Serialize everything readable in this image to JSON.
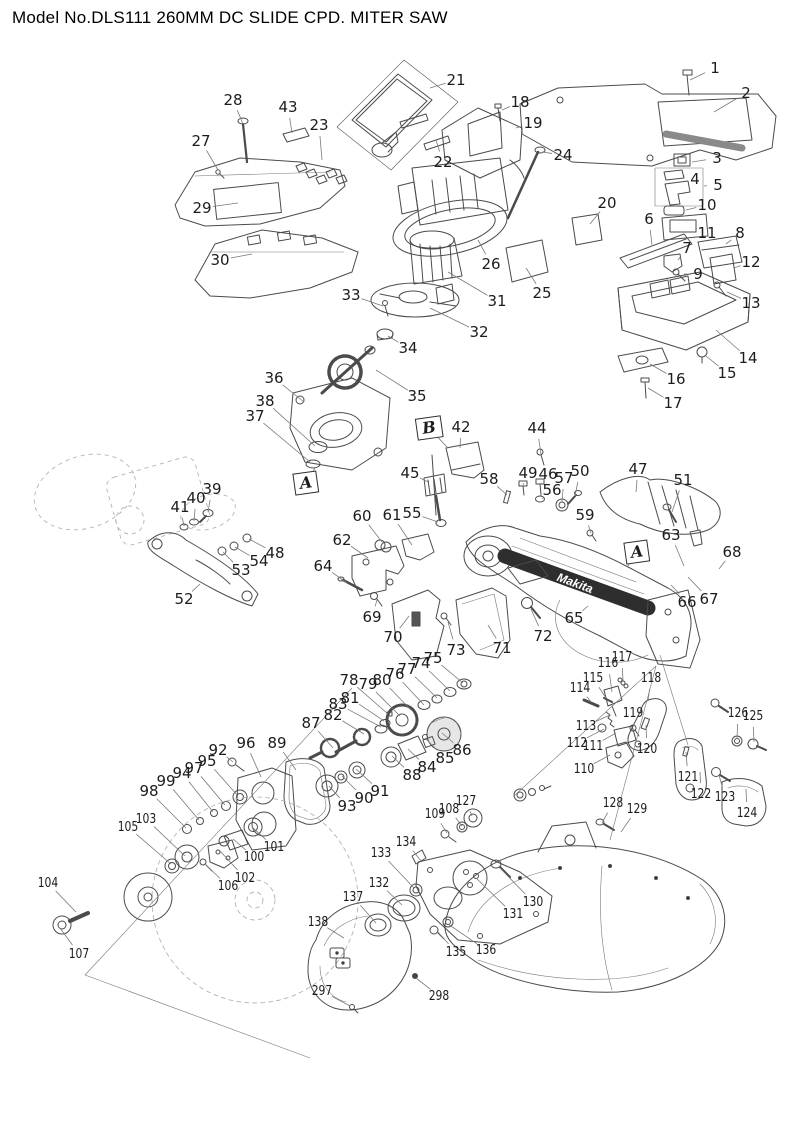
{
  "title": "Model No.DLS111 260MM DC SLIDE CPD. MITER SAW",
  "diagram": {
    "type": "exploded-parts-diagram",
    "brand_marking": "Makita",
    "view_refs": [
      {
        "label": "A",
        "x": 306,
        "y": 483,
        "tx": 315,
        "ty": 468
      },
      {
        "label": "B",
        "x": 429,
        "y": 428,
        "tx": 448,
        "ty": 448
      },
      {
        "label": "A",
        "x": 637,
        "y": 552,
        "tx": 628,
        "ty": 566
      }
    ],
    "callouts": [
      {
        "n": "1",
        "x": 715,
        "y": 68,
        "tx": 690,
        "ty": 80
      },
      {
        "n": "2",
        "x": 746,
        "y": 93,
        "tx": 714,
        "ty": 112
      },
      {
        "n": "3",
        "x": 717,
        "y": 158,
        "tx": 692,
        "ty": 162
      },
      {
        "n": "4",
        "x": 695,
        "y": 179,
        "tx": 684,
        "ty": 176
      },
      {
        "n": "5",
        "x": 718,
        "y": 185,
        "tx": 704,
        "ty": 186
      },
      {
        "n": "6",
        "x": 649,
        "y": 219,
        "tx": 652,
        "ty": 245
      },
      {
        "n": "7",
        "x": 687,
        "y": 248,
        "tx": 678,
        "ty": 260
      },
      {
        "n": "8",
        "x": 740,
        "y": 233,
        "tx": 726,
        "ty": 244
      },
      {
        "n": "9",
        "x": 698,
        "y": 274,
        "tx": 684,
        "ty": 274
      },
      {
        "n": "10",
        "x": 707,
        "y": 205,
        "tx": 686,
        "ty": 210
      },
      {
        "n": "11",
        "x": 707,
        "y": 233,
        "tx": 696,
        "ty": 228
      },
      {
        "n": "12",
        "x": 751,
        "y": 262,
        "tx": 734,
        "ty": 268
      },
      {
        "n": "13",
        "x": 751,
        "y": 303,
        "tx": 727,
        "ty": 292
      },
      {
        "n": "14",
        "x": 748,
        "y": 358,
        "tx": 716,
        "ty": 330
      },
      {
        "n": "15",
        "x": 727,
        "y": 373,
        "tx": 706,
        "ty": 356
      },
      {
        "n": "16",
        "x": 676,
        "y": 379,
        "tx": 650,
        "ty": 364
      },
      {
        "n": "17",
        "x": 673,
        "y": 403,
        "tx": 648,
        "ty": 388
      },
      {
        "n": "18",
        "x": 520,
        "y": 102,
        "tx": 502,
        "ty": 110
      },
      {
        "n": "19",
        "x": 533,
        "y": 123,
        "tx": 516,
        "ty": 128
      },
      {
        "n": "20",
        "x": 607,
        "y": 203,
        "tx": 590,
        "ty": 224
      },
      {
        "n": "21",
        "x": 456,
        "y": 80,
        "tx": 430,
        "ty": 88
      },
      {
        "n": "22",
        "x": 443,
        "y": 162,
        "tx": 436,
        "ty": 140
      },
      {
        "n": "23",
        "x": 319,
        "y": 125,
        "tx": 322,
        "ty": 160
      },
      {
        "n": "24",
        "x": 563,
        "y": 155,
        "tx": 542,
        "ty": 152
      },
      {
        "n": "25",
        "x": 542,
        "y": 293,
        "tx": 526,
        "ty": 268
      },
      {
        "n": "26",
        "x": 491,
        "y": 264,
        "tx": 478,
        "ty": 240
      },
      {
        "n": "27",
        "x": 201,
        "y": 141,
        "tx": 218,
        "ty": 170
      },
      {
        "n": "28",
        "x": 233,
        "y": 100,
        "tx": 243,
        "ty": 124
      },
      {
        "n": "29",
        "x": 202,
        "y": 208,
        "tx": 238,
        "ty": 203
      },
      {
        "n": "30",
        "x": 220,
        "y": 260,
        "tx": 252,
        "ty": 254
      },
      {
        "n": "31",
        "x": 497,
        "y": 301,
        "tx": 448,
        "ty": 272
      },
      {
        "n": "32",
        "x": 479,
        "y": 332,
        "tx": 430,
        "ty": 308
      },
      {
        "n": "33",
        "x": 351,
        "y": 295,
        "tx": 383,
        "ty": 306
      },
      {
        "n": "34",
        "x": 408,
        "y": 348,
        "tx": 388,
        "ty": 336
      },
      {
        "n": "35",
        "x": 417,
        "y": 396,
        "tx": 376,
        "ty": 370
      },
      {
        "n": "36",
        "x": 274,
        "y": 378,
        "tx": 304,
        "ty": 402
      },
      {
        "n": "37",
        "x": 255,
        "y": 416,
        "tx": 310,
        "ty": 462
      },
      {
        "n": "38",
        "x": 265,
        "y": 401,
        "tx": 315,
        "ty": 446
      },
      {
        "n": "39",
        "x": 212,
        "y": 489,
        "tx": 208,
        "ty": 512
      },
      {
        "n": "40",
        "x": 196,
        "y": 498,
        "tx": 194,
        "ty": 521
      },
      {
        "n": "41",
        "x": 180,
        "y": 507,
        "tx": 184,
        "ty": 526
      },
      {
        "n": "42",
        "x": 461,
        "y": 427,
        "tx": 460,
        "ty": 448
      },
      {
        "n": "43",
        "x": 288,
        "y": 107,
        "tx": 292,
        "ty": 133
      },
      {
        "n": "44",
        "x": 537,
        "y": 428,
        "tx": 541,
        "ty": 454
      },
      {
        "n": "45",
        "x": 410,
        "y": 473,
        "tx": 428,
        "ty": 482
      },
      {
        "n": "46",
        "x": 548,
        "y": 474,
        "tx": 541,
        "ty": 483
      },
      {
        "n": "47",
        "x": 638,
        "y": 469,
        "tx": 636,
        "ty": 492
      },
      {
        "n": "48",
        "x": 275,
        "y": 553,
        "tx": 249,
        "ty": 539
      },
      {
        "n": "49",
        "x": 528,
        "y": 473,
        "tx": 523,
        "ty": 485
      },
      {
        "n": "50",
        "x": 580,
        "y": 471,
        "tx": 575,
        "ty": 496
      },
      {
        "n": "51",
        "x": 683,
        "y": 480,
        "tx": 672,
        "ty": 512
      },
      {
        "n": "52",
        "x": 184,
        "y": 599,
        "tx": 200,
        "ty": 584
      },
      {
        "n": "53",
        "x": 241,
        "y": 570,
        "tx": 223,
        "ty": 552
      },
      {
        "n": "54",
        "x": 259,
        "y": 561,
        "tx": 235,
        "ty": 547
      },
      {
        "n": "55",
        "x": 412,
        "y": 513,
        "tx": 438,
        "ty": 522
      },
      {
        "n": "56",
        "x": 552,
        "y": 490,
        "tx": 542,
        "ty": 499
      },
      {
        "n": "57",
        "x": 564,
        "y": 478,
        "tx": 562,
        "ty": 502
      },
      {
        "n": "58",
        "x": 489,
        "y": 479,
        "tx": 507,
        "ty": 495
      },
      {
        "n": "59",
        "x": 585,
        "y": 515,
        "tx": 591,
        "ty": 533
      },
      {
        "n": "60",
        "x": 362,
        "y": 516,
        "tx": 382,
        "ty": 542
      },
      {
        "n": "61",
        "x": 392,
        "y": 515,
        "tx": 412,
        "ty": 545
      },
      {
        "n": "62",
        "x": 342,
        "y": 540,
        "tx": 368,
        "ty": 558
      },
      {
        "n": "63",
        "x": 671,
        "y": 535,
        "tx": 684,
        "ty": 566
      },
      {
        "n": "64",
        "x": 323,
        "y": 566,
        "tx": 347,
        "ty": 583
      },
      {
        "n": "65",
        "x": 574,
        "y": 618,
        "tx": 588,
        "ty": 606
      },
      {
        "n": "66",
        "x": 687,
        "y": 602,
        "tx": 671,
        "ty": 585
      },
      {
        "n": "67",
        "x": 709,
        "y": 599,
        "tx": 688,
        "ty": 577
      },
      {
        "n": "68",
        "x": 732,
        "y": 552,
        "tx": 719,
        "ty": 569
      },
      {
        "n": "69",
        "x": 372,
        "y": 617,
        "tx": 377,
        "ty": 600
      },
      {
        "n": "70",
        "x": 393,
        "y": 637,
        "tx": 409,
        "ty": 616
      },
      {
        "n": "71",
        "x": 502,
        "y": 648,
        "tx": 488,
        "ty": 625
      },
      {
        "n": "72",
        "x": 543,
        "y": 636,
        "tx": 531,
        "ty": 609
      },
      {
        "n": "73",
        "x": 456,
        "y": 650,
        "tx": 448,
        "ty": 622
      },
      {
        "n": "74",
        "x": 421,
        "y": 663,
        "tx": 450,
        "ty": 691
      },
      {
        "n": "75",
        "x": 433,
        "y": 658,
        "tx": 463,
        "ty": 683
      },
      {
        "n": "76",
        "x": 395,
        "y": 674,
        "tx": 424,
        "ty": 705
      },
      {
        "n": "77",
        "x": 407,
        "y": 669,
        "tx": 437,
        "ty": 698
      },
      {
        "n": "78",
        "x": 349,
        "y": 680,
        "tx": 388,
        "ty": 714
      },
      {
        "n": "79",
        "x": 368,
        "y": 684,
        "tx": 400,
        "ty": 716
      },
      {
        "n": "80",
        "x": 382,
        "y": 680,
        "tx": 411,
        "ty": 710
      },
      {
        "n": "81",
        "x": 350,
        "y": 698,
        "tx": 384,
        "ty": 721
      },
      {
        "n": "82",
        "x": 333,
        "y": 715,
        "tx": 364,
        "ty": 734
      },
      {
        "n": "83",
        "x": 338,
        "y": 704,
        "tx": 381,
        "ty": 727
      },
      {
        "n": "84",
        "x": 427,
        "y": 767,
        "tx": 408,
        "ty": 749
      },
      {
        "n": "85",
        "x": 445,
        "y": 758,
        "tx": 425,
        "ty": 738
      },
      {
        "n": "86",
        "x": 462,
        "y": 750,
        "tx": 442,
        "ty": 733
      },
      {
        "n": "87",
        "x": 311,
        "y": 723,
        "tx": 333,
        "ty": 748
      },
      {
        "n": "88",
        "x": 412,
        "y": 775,
        "tx": 392,
        "ty": 756
      },
      {
        "n": "89",
        "x": 277,
        "y": 743,
        "tx": 296,
        "ty": 770
      },
      {
        "n": "90",
        "x": 364,
        "y": 798,
        "tx": 342,
        "ty": 776
      },
      {
        "n": "91",
        "x": 380,
        "y": 791,
        "tx": 356,
        "ty": 769
      },
      {
        "n": "92",
        "x": 218,
        "y": 750,
        "tx": 233,
        "ty": 762
      },
      {
        "n": "93",
        "x": 347,
        "y": 806,
        "tx": 329,
        "ty": 786
      },
      {
        "n": "94",
        "x": 182,
        "y": 773,
        "tx": 213,
        "ty": 812
      },
      {
        "n": "95",
        "x": 207,
        "y": 761,
        "tx": 238,
        "ty": 796
      },
      {
        "n": "96",
        "x": 246,
        "y": 743,
        "tx": 261,
        "ty": 777
      },
      {
        "n": "97",
        "x": 194,
        "y": 768,
        "tx": 225,
        "ty": 805
      },
      {
        "n": "98",
        "x": 149,
        "y": 791,
        "tx": 186,
        "ty": 828
      },
      {
        "n": "99",
        "x": 166,
        "y": 781,
        "tx": 199,
        "ty": 820
      },
      {
        "n": "100",
        "x": 254,
        "y": 857,
        "tx": 233,
        "ty": 839
      },
      {
        "n": "101",
        "x": 274,
        "y": 847,
        "tx": 252,
        "ty": 827
      },
      {
        "n": "102",
        "x": 245,
        "y": 878,
        "tx": 220,
        "ty": 851
      },
      {
        "n": "103",
        "x": 146,
        "y": 819,
        "tx": 185,
        "ty": 856
      },
      {
        "n": "104",
        "x": 48,
        "y": 883,
        "tx": 76,
        "ty": 912
      },
      {
        "n": "105",
        "x": 128,
        "y": 827,
        "tx": 171,
        "ty": 864
      },
      {
        "n": "106",
        "x": 228,
        "y": 886,
        "tx": 205,
        "ty": 864
      },
      {
        "n": "107",
        "x": 79,
        "y": 954,
        "tx": 60,
        "ty": 928
      },
      {
        "n": "108",
        "x": 449,
        "y": 809,
        "tx": 462,
        "ty": 826
      },
      {
        "n": "109",
        "x": 435,
        "y": 814,
        "tx": 447,
        "ty": 833
      },
      {
        "n": "110",
        "x": 584,
        "y": 769,
        "tx": 610,
        "ty": 755
      },
      {
        "n": "111",
        "x": 593,
        "y": 746,
        "tx": 616,
        "ty": 733
      },
      {
        "n": "112",
        "x": 577,
        "y": 743,
        "tx": 604,
        "ty": 729
      },
      {
        "n": "113",
        "x": 586,
        "y": 726,
        "tx": 610,
        "ty": 715
      },
      {
        "n": "114",
        "x": 580,
        "y": 688,
        "tx": 591,
        "ty": 702
      },
      {
        "n": "115",
        "x": 593,
        "y": 678,
        "tx": 606,
        "ty": 698
      },
      {
        "n": "116",
        "x": 608,
        "y": 663,
        "tx": 612,
        "ty": 692
      },
      {
        "n": "117",
        "x": 622,
        "y": 657,
        "tx": 623,
        "ty": 681
      },
      {
        "n": "118",
        "x": 651,
        "y": 678,
        "tx": 648,
        "ty": 701
      },
      {
        "n": "119",
        "x": 633,
        "y": 713,
        "tx": 634,
        "ty": 726
      },
      {
        "n": "120",
        "x": 647,
        "y": 749,
        "tx": 646,
        "ty": 725
      },
      {
        "n": "121",
        "x": 688,
        "y": 777,
        "tx": 686,
        "ty": 752
      },
      {
        "n": "122",
        "x": 701,
        "y": 794,
        "tx": 700,
        "ty": 772
      },
      {
        "n": "123",
        "x": 725,
        "y": 797,
        "tx": 719,
        "ty": 775
      },
      {
        "n": "124",
        "x": 747,
        "y": 813,
        "tx": 746,
        "ty": 789
      },
      {
        "n": "125",
        "x": 753,
        "y": 716,
        "tx": 754,
        "ty": 742
      },
      {
        "n": "126",
        "x": 738,
        "y": 713,
        "tx": 737,
        "ty": 739
      },
      {
        "n": "127",
        "x": 466,
        "y": 801,
        "tx": 472,
        "ty": 816
      },
      {
        "n": "128",
        "x": 613,
        "y": 803,
        "tx": 602,
        "ty": 823
      },
      {
        "n": "129",
        "x": 637,
        "y": 809,
        "tx": 621,
        "ty": 832
      },
      {
        "n": "130",
        "x": 533,
        "y": 902,
        "tx": 500,
        "ty": 868
      },
      {
        "n": "131",
        "x": 513,
        "y": 914,
        "tx": 476,
        "ty": 878
      },
      {
        "n": "132",
        "x": 379,
        "y": 883,
        "tx": 402,
        "ty": 905
      },
      {
        "n": "133",
        "x": 381,
        "y": 853,
        "tx": 414,
        "ty": 888
      },
      {
        "n": "134",
        "x": 406,
        "y": 842,
        "tx": 421,
        "ty": 861
      },
      {
        "n": "135",
        "x": 456,
        "y": 952,
        "tx": 437,
        "ty": 931
      },
      {
        "n": "136",
        "x": 486,
        "y": 950,
        "tx": 448,
        "ty": 924
      },
      {
        "n": "137",
        "x": 353,
        "y": 897,
        "tx": 376,
        "ty": 923
      },
      {
        "n": "138",
        "x": 318,
        "y": 922,
        "tx": 344,
        "ty": 938
      },
      {
        "n": "297",
        "x": 322,
        "y": 991,
        "tx": 350,
        "ty": 1006
      },
      {
        "n": "298",
        "x": 439,
        "y": 996,
        "tx": 416,
        "ty": 978
      }
    ]
  }
}
